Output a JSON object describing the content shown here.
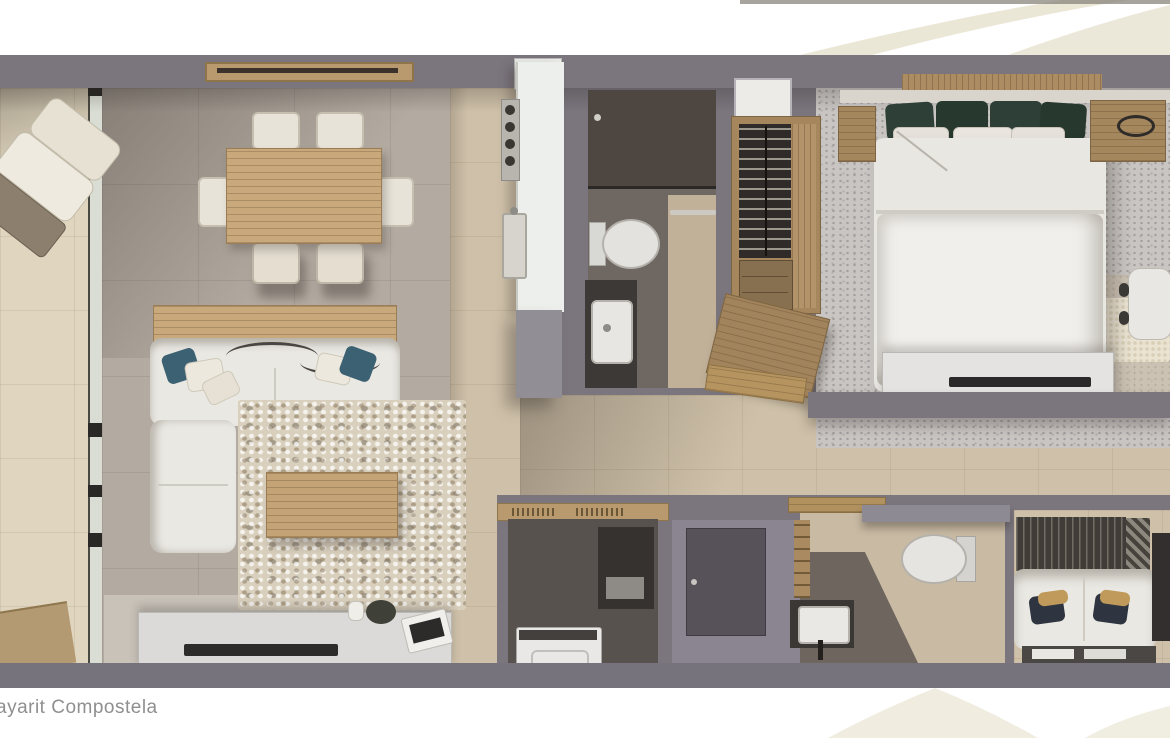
{
  "caption": {
    "text": "ayarit Compostela"
  },
  "palette": {
    "wall": "#7b767e",
    "floor_tile": "#b3aaa1",
    "floor_beige": "#cfc1a9",
    "balcony_tile": "#e0d6bf",
    "carpet": "#c9c5c2",
    "wood": "#b99a6e",
    "wood_light": "#c9a97c",
    "upholstery": "#eae8e3",
    "accent_teal": "#3c6173",
    "accent_green_dark": "#2e3f37",
    "accent_navy": "#2e3440",
    "accent_gold": "#c09a5a",
    "dark_fixture": "#3a3734",
    "watermark_cream": "#e9e4d2",
    "background": "#ffffff",
    "caption_color": "#8f8f8f"
  }
}
